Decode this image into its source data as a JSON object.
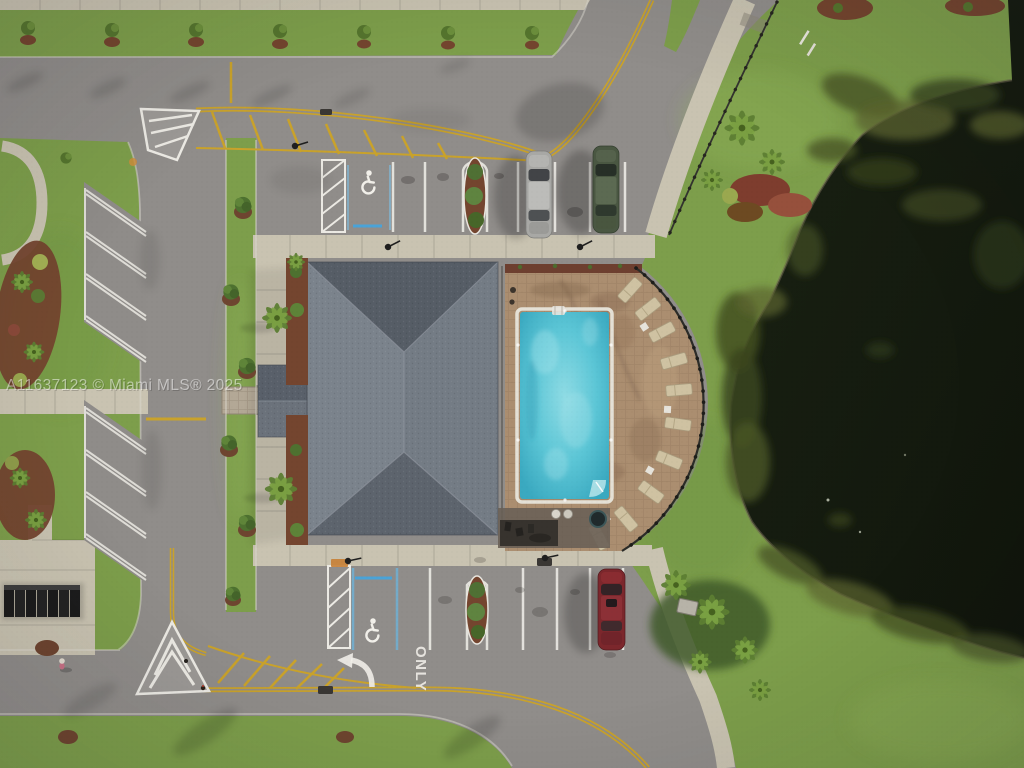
{
  "image": {
    "kind": "aerial-drone-photograph",
    "subject": "community clubhouse amenity area with swimming pool, parking lots, access roads and a pond",
    "view": "top-down overhead",
    "lighting": "late-day warm light with long shadows toward the west"
  },
  "watermark": {
    "text": "A11637123 © Miami MLS® 2025",
    "style": "semi-transparent white overlay text"
  },
  "pavement_text": {
    "lane_word": "ONLY",
    "turn_arrow": "left-turn curved arrow",
    "accessible_symbol_count": 2
  },
  "site": {
    "building": {
      "type": "clubhouse",
      "roof": "gray shingle hip roof",
      "entry_extension_side": "west"
    },
    "pool": {
      "shape": "rectangular",
      "deck": "tan paver deck with semicircular east edge",
      "fence": "dark metal fence along curved edge",
      "lounge_chair_count": 10,
      "ladder_position": "north end",
      "steps_position": "southeast corner"
    },
    "pond": {
      "appearance": "dark water with algae mats along shoreline",
      "location": "east side"
    },
    "parking": {
      "north_row": {
        "stall_count_approx": 8,
        "accessible_stall": true,
        "hatched_no_parking_zone": true,
        "landscape_island": true,
        "vehicles": [
          "silver sedan",
          "dark-green sedan"
        ]
      },
      "south_row": {
        "stall_count_approx": 8,
        "accessible_stall": true,
        "hatched_no_parking_zone": true,
        "landscape_island": true,
        "vehicles": [
          "dark-red sedan"
        ]
      },
      "west_angled_stalls": {
        "groups": 2,
        "stalls_per_group": 3
      }
    },
    "roads": {
      "center_line": "double yellow",
      "gore_markings": "white chevron islands with yellow hatch wedges",
      "junction_count": 2
    },
    "mail_area": {
      "type": "cluster mailboxes on concrete pad",
      "unit_count_approx": 7
    },
    "landscaping": [
      "palm trees",
      "red mulch shrub beds",
      "street shrubs along north sidewalk",
      "oval parking islands"
    ],
    "other_features": [
      "light poles",
      "storm drains",
      "pedestrian near mailboxes",
      "pool equipment pad",
      "utility box",
      "sidewalk railing along curve"
    ]
  },
  "colors": {
    "asphalt": "#908d8a",
    "asphalt_light": "#9c9996",
    "concrete": "#c9c3b1",
    "paver_walk": "#b3a896",
    "grass": "#7d9e4b",
    "grass_bright": "#8fb158",
    "lake": "#161c10",
    "algae": "#55602c",
    "pool_water": "#55c3d4",
    "pool_water_light": "#8edbe4",
    "pool_coping": "#e5e1d6",
    "deck": "#ab8e70",
    "deck_stain": "#8a6d52",
    "deck_wall": "#6d3f2f",
    "roof_dark": "#565d66",
    "roof_light": "#7b838c",
    "mulch": "#74452f",
    "palm": "#5d7f33",
    "palm_light": "#7da344",
    "shrub": "#4e7130",
    "marking_white": "#eceae4",
    "marking_yellow": "#c9a22b",
    "accessible_blue": "#4aa3d8",
    "car_silver": "#a8a8a5",
    "car_green": "#4a5742",
    "car_red": "#7c272c",
    "chair": "#cfc2a2",
    "fence": "#2c2c28",
    "mailbox": "#1c1c1c",
    "watermark": "#ffffff"
  }
}
